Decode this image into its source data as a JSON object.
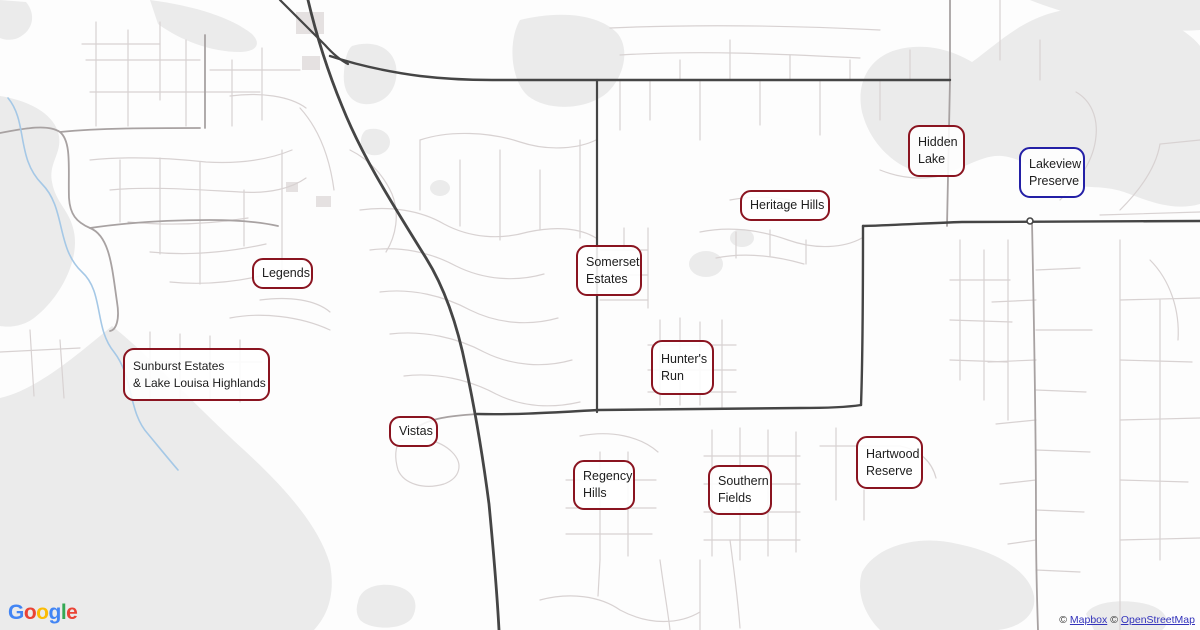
{
  "badges": [
    {
      "line1": "Hidden",
      "line2": "Lake",
      "style": "red"
    },
    {
      "line1": "Lakeview",
      "line2": "Preserve",
      "style": "blue"
    },
    {
      "line1": "Heritage Hills",
      "style": "red"
    },
    {
      "line1": "Somerset",
      "line2": "Estates",
      "style": "red"
    },
    {
      "line1": "Legends",
      "style": "red"
    },
    {
      "line1": "Sunburst Estates",
      "line2": "& Lake Louisa Highlands",
      "style": "red"
    },
    {
      "line1": "Hunter's",
      "line2": "Run",
      "style": "red"
    },
    {
      "line1": "Vistas",
      "style": "red"
    },
    {
      "line1": "Regency",
      "line2": "Hills",
      "style": "red"
    },
    {
      "line1": "Southern",
      "line2": "Fields",
      "style": "red"
    },
    {
      "line1": "Hartwood",
      "line2": "Reserve",
      "style": "red"
    }
  ],
  "google_logo": {
    "letters": [
      "G",
      "o",
      "o",
      "g",
      "l",
      "e"
    ],
    "colors": [
      "#4285F4",
      "#EA4335",
      "#FBBC05",
      "#4285F4",
      "#34A853",
      "#EA4335"
    ]
  },
  "attribution": {
    "sym1": "©",
    "mapbox": "Mapbox",
    "sym2": "©",
    "openstreetmap": "OpenStreetMap",
    "link_color": "#3333bb"
  },
  "colors": {
    "badge_red_border": "#8a1420",
    "badge_blue_border": "#2420a6",
    "badge_text": "#1d1d1d",
    "water_gray": "#ebebeb",
    "road_dark": "#454545",
    "road_medium": "#a8a2a2",
    "road_light": "#d8d2d2",
    "stream_blue": "#a5c8e6"
  }
}
